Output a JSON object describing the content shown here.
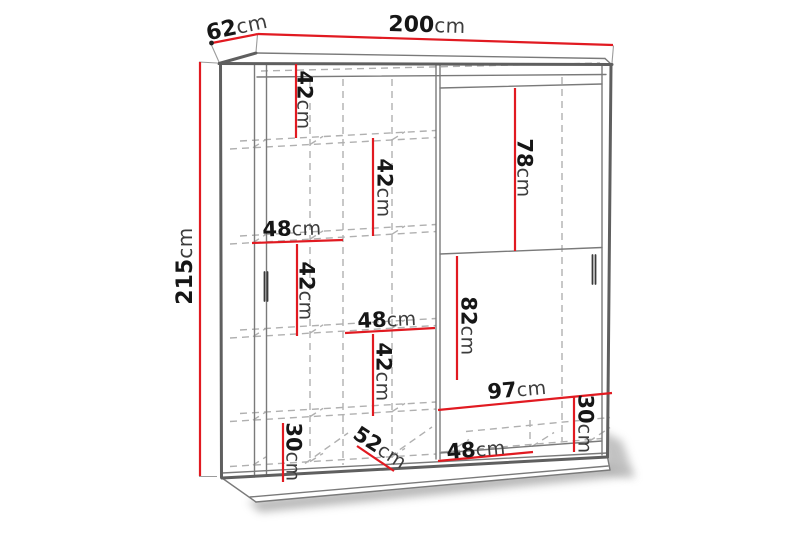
{
  "diagram": {
    "type": "furniture-dimension-diagram",
    "subject": "two-door sliding wardrobe with interior shelving",
    "unit": "cm",
    "overall_dimensions": {
      "width": {
        "value": "200",
        "unit": "cm"
      },
      "depth": {
        "value": "62",
        "unit": "cm"
      },
      "height": {
        "value": "215",
        "unit": "cm"
      }
    },
    "labels": {
      "width_top": {
        "value": "200",
        "unit": "cm"
      },
      "depth_top": {
        "value": "62",
        "unit": "cm"
      },
      "height_left": {
        "value": "215",
        "unit": "cm"
      },
      "shelf_42_a": {
        "value": "42",
        "unit": "cm"
      },
      "shelf_42_b": {
        "value": "42",
        "unit": "cm"
      },
      "shelf_48_a": {
        "value": "48",
        "unit": "cm"
      },
      "shelf_42_c": {
        "value": "42",
        "unit": "cm"
      },
      "door_78": {
        "value": "78",
        "unit": "cm"
      },
      "shelf_48_b": {
        "value": "48",
        "unit": "cm"
      },
      "shelf_42_d": {
        "value": "42",
        "unit": "cm"
      },
      "door_82": {
        "value": "82",
        "unit": "cm"
      },
      "bottom_97": {
        "value": "97",
        "unit": "cm"
      },
      "bottom_30_right": {
        "value": "30",
        "unit": "cm"
      },
      "bottom_30_left": {
        "value": "30",
        "unit": "cm"
      },
      "diagonal_52": {
        "value": "52",
        "unit": "cm"
      },
      "bottom_48": {
        "value": "48",
        "unit": "cm"
      }
    },
    "colors": {
      "dimension_line": "#e11a21",
      "outline": "#5f5f5f",
      "hidden_line": "#b0b0b0",
      "text": "#161616",
      "background": "#ffffff"
    }
  }
}
